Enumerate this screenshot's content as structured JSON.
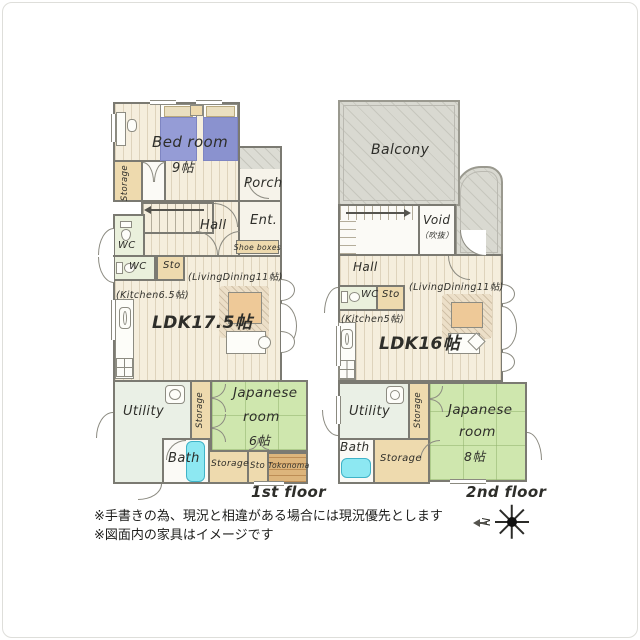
{
  "floor1": {
    "caption": "1st floor",
    "bedroom": {
      "name": "Bed room",
      "size": "9帖"
    },
    "storage_left": "Storage",
    "porch": "Porch",
    "entrance": "Ent.",
    "shoe_boxes": "Shoe boxes",
    "hall": "Hall",
    "wc_upper": "WC",
    "wc_lower": "WC",
    "sto": "Sto",
    "living_dining": "(LivingDining11帖)",
    "kitchen": "(Kitchen6.5帖)",
    "ldk": "LDK17.5帖",
    "utility": "Utility",
    "storage_mid": "Storage",
    "japanese": {
      "line1": "Japanese",
      "line2": "room",
      "size": "6帖"
    },
    "bath": "Bath",
    "storage_bottom": "Storage",
    "sto_bottom": "Sto",
    "tokonoma": "Tokonoma"
  },
  "floor2": {
    "caption": "2nd floor",
    "balcony": "Balcony",
    "void": {
      "line1": "Void",
      "line2": "（吹抜）"
    },
    "hall": "Hall",
    "wc": "WC",
    "sto": "Sto",
    "living_dining": "(LivingDining11帖)",
    "kitchen": "(Kitchen5帖)",
    "ldk": "LDK16帖",
    "utility": "Utility",
    "storage_mid": "Storage",
    "japanese": {
      "line1": "Japanese",
      "line2": "room",
      "size": "8帖"
    },
    "bath": "Bath",
    "storage_bottom": "Storage"
  },
  "notes": {
    "line1": "※手書きの為、現況と相違がある場合には現況優先とします",
    "line2": "※図面内の家具はイメージです"
  },
  "compass": {
    "north_label": "N"
  },
  "colors": {
    "wall": "#7b7a72",
    "wood_floor": "#f5eedd",
    "tatami_green": "#cfe7ae",
    "storage_tan": "#eedaae",
    "balcony_gray": "#d9d9d1",
    "bathtub_cyan": "#8de8f2",
    "bed_blue": "#959cd6",
    "wc_floor": "#eaf0dc",
    "utility_floor": "#eaf0e6",
    "tokonoma_brown": "#ddb57c"
  }
}
